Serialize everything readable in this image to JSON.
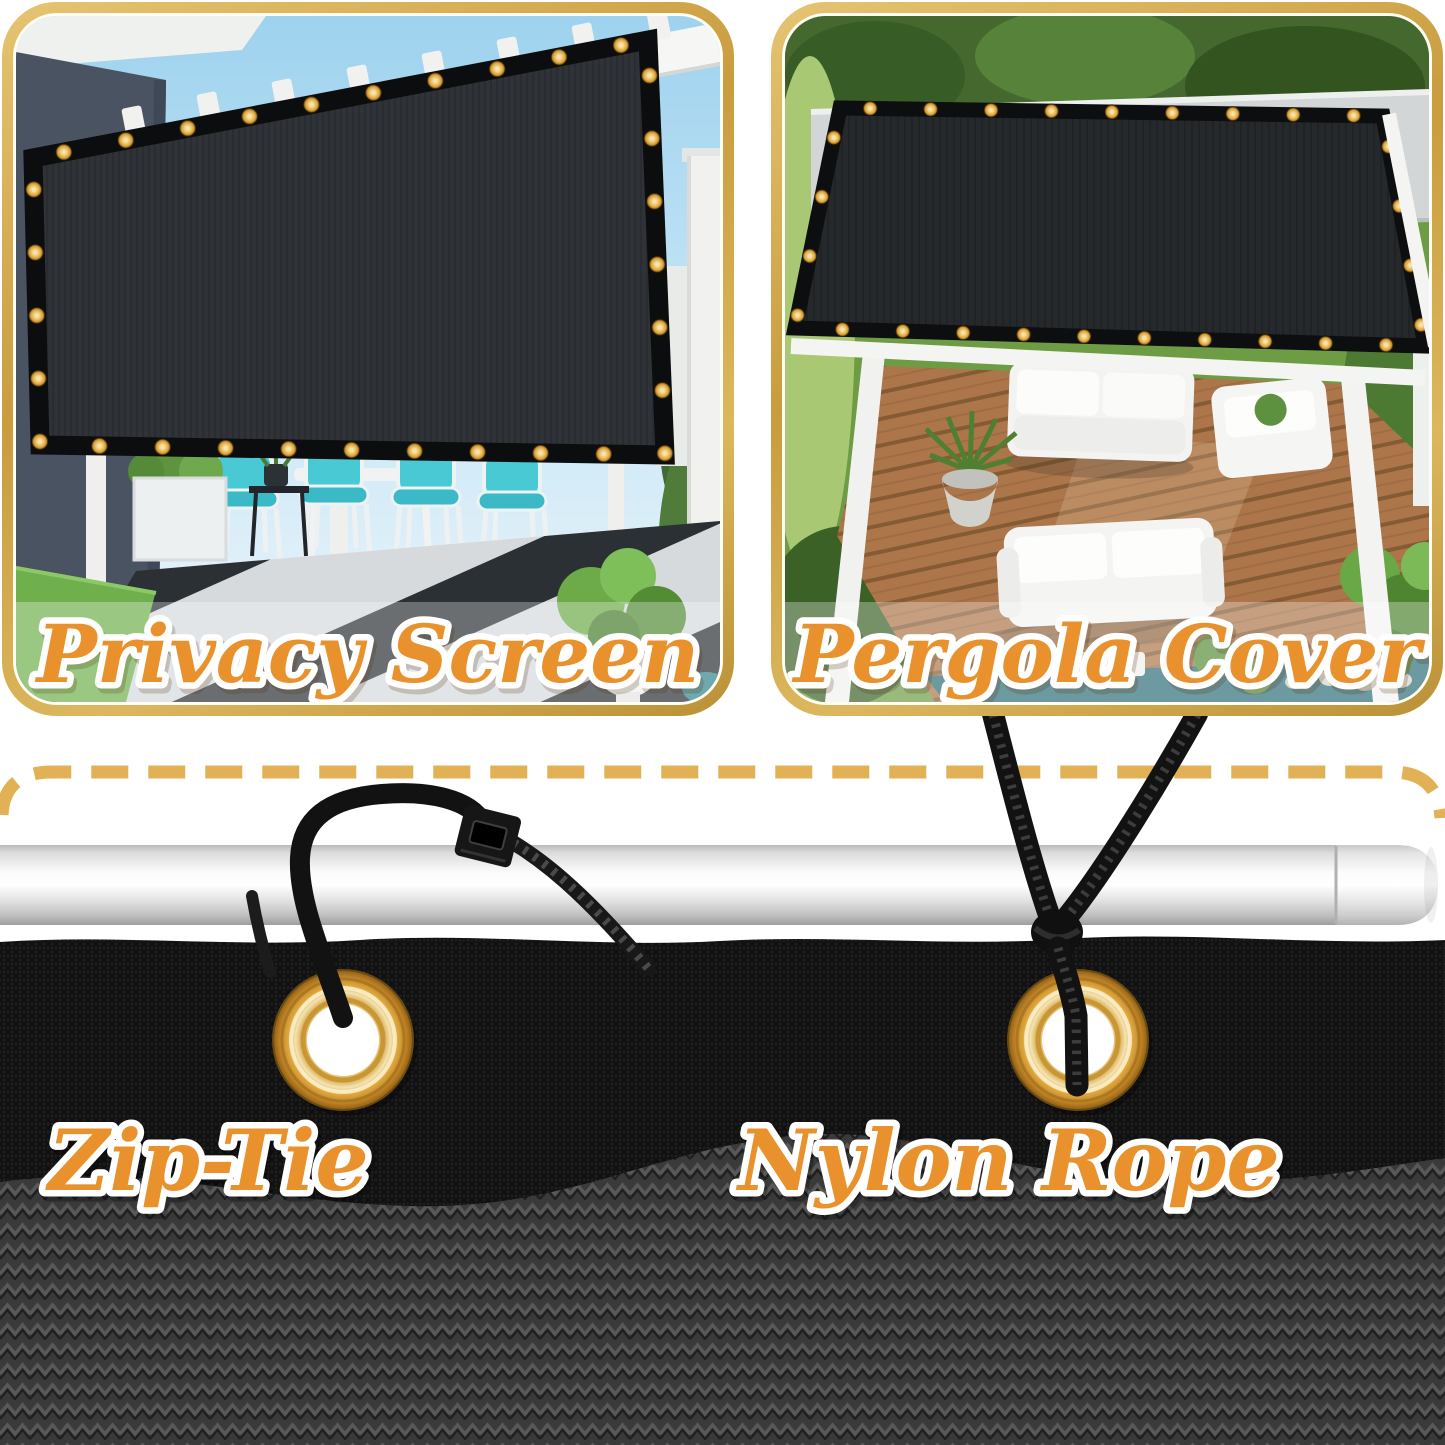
{
  "page": {
    "background": "#ffffff",
    "description": "Shade screen product usage collage"
  },
  "panels": [
    {
      "name": "privacy-screen",
      "label": "Privacy Screen"
    },
    {
      "name": "pergola-cover",
      "label": "Pergola Cover"
    }
  ],
  "hardware": [
    {
      "name": "zip-tie",
      "label": "Zip-Tie"
    },
    {
      "name": "nylon-rope",
      "label": "Nylon Rope"
    }
  ],
  "colors": {
    "label_orange": "#e8912d",
    "label_outline": "#ffffff",
    "panel_border_gold": "#d0a74c",
    "dashed_line_gold": "#e2b155",
    "grommet_gold": "#dfa93f",
    "fabric_black": "#2e3236",
    "mesh_dark": "#191919",
    "weave_gray": "#3a3a3a",
    "pole_silver": "#e9e9e9",
    "chair_teal": "#49c9d4",
    "deck_wood": "#ad764a",
    "grass_green": "#6fb04c",
    "sky_blue": "#9ed2ee"
  }
}
